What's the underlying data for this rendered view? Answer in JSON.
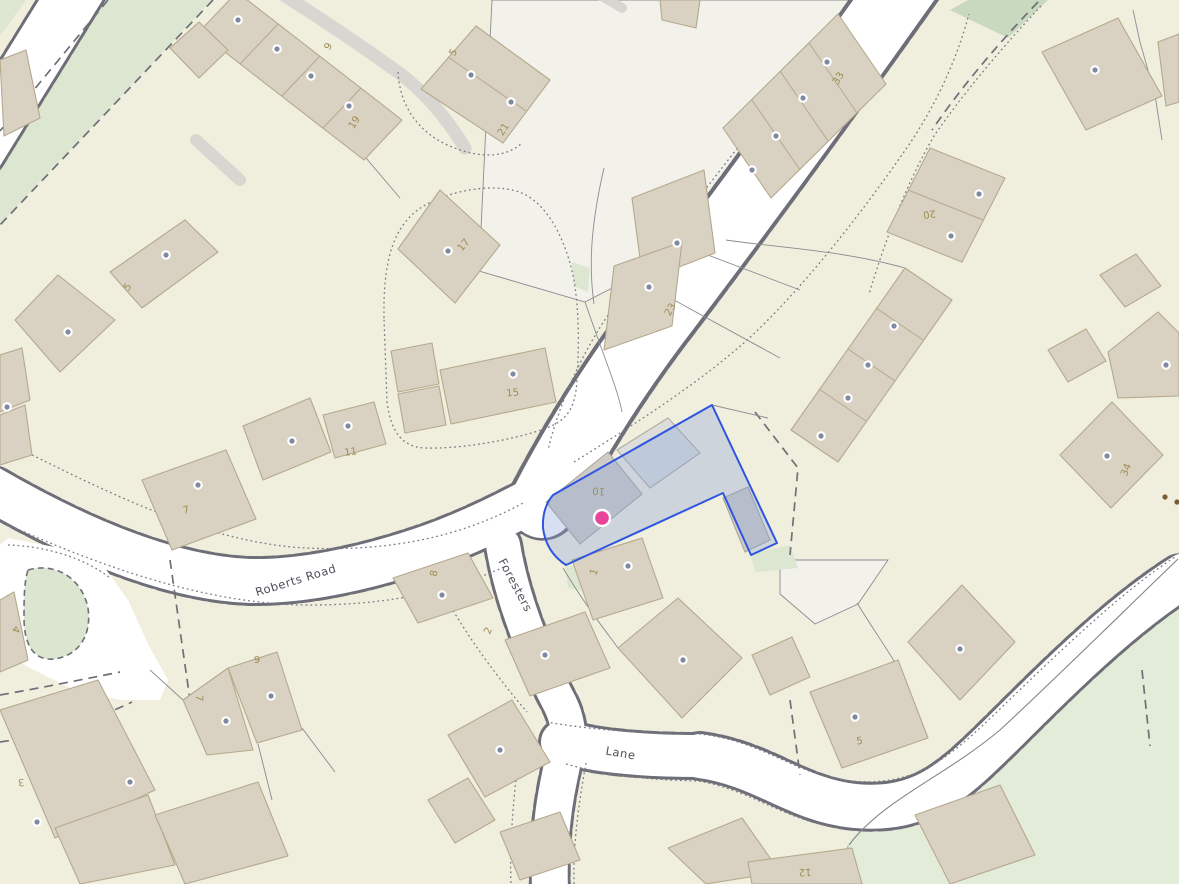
{
  "map": {
    "road_labels": [
      {
        "text": "Roberts Road",
        "x": 297,
        "y": 584,
        "rot": -17
      },
      {
        "text": "Foresters",
        "x": 512,
        "y": 587,
        "rot": 62
      },
      {
        "text": "Lane",
        "x": 620,
        "y": 757,
        "rot": 10
      }
    ],
    "house_numbers": [
      {
        "text": "9",
        "x": 331,
        "y": 48,
        "rot": -58
      },
      {
        "text": "19",
        "x": 357,
        "y": 124,
        "rot": -58
      },
      {
        "text": "5",
        "x": 456,
        "y": 54,
        "rot": -58
      },
      {
        "text": "21",
        "x": 506,
        "y": 131,
        "rot": -58
      },
      {
        "text": "33",
        "x": 841,
        "y": 80,
        "rot": -58
      },
      {
        "text": "17",
        "x": 466,
        "y": 247,
        "rot": -50
      },
      {
        "text": "23",
        "x": 673,
        "y": 311,
        "rot": -60
      },
      {
        "text": "15",
        "x": 513,
        "y": 396,
        "rot": -6
      },
      {
        "text": "11",
        "x": 351,
        "y": 455,
        "rot": -8
      },
      {
        "text": "5",
        "x": 130,
        "y": 289,
        "rot": -50
      },
      {
        "text": "7",
        "x": 187,
        "y": 513,
        "rot": -15
      },
      {
        "text": "20",
        "x": 929,
        "y": 211,
        "rot": 172
      },
      {
        "text": "34",
        "x": 1129,
        "y": 471,
        "rot": -68
      },
      {
        "text": "8",
        "x": 437,
        "y": 574,
        "rot": -78
      },
      {
        "text": "2",
        "x": 491,
        "y": 632,
        "rot": -65
      },
      {
        "text": "1",
        "x": 597,
        "y": 573,
        "rot": -70
      },
      {
        "text": "5",
        "x": 860,
        "y": 744,
        "rot": -8
      },
      {
        "text": "9",
        "x": 257,
        "y": 663,
        "rot": 0
      },
      {
        "text": "7",
        "x": 196,
        "y": 698,
        "rot": 92
      },
      {
        "text": "3",
        "x": 21,
        "y": 779,
        "rot": 175
      },
      {
        "text": "4",
        "x": 13,
        "y": 628,
        "rot": 115
      },
      {
        "text": "12",
        "x": 805,
        "y": 869,
        "rot": 178
      },
      {
        "text": "10",
        "x": 599,
        "y": 488,
        "rot": 186
      }
    ],
    "marker": {
      "x": 602,
      "y": 518,
      "radius": 8,
      "color": "#e8449a",
      "ring": "#ffffff"
    },
    "selection": {
      "stroke": "#2f55e0",
      "fill": "rgba(130,160,215,0.32)"
    },
    "entrance_markers": [
      [
        238,
        20
      ],
      [
        277,
        49
      ],
      [
        311,
        76
      ],
      [
        349,
        106
      ],
      [
        471,
        75
      ],
      [
        511,
        102
      ],
      [
        827,
        62
      ],
      [
        803,
        98
      ],
      [
        776,
        136
      ],
      [
        752,
        170
      ],
      [
        1095,
        70
      ],
      [
        979,
        194
      ],
      [
        951,
        236
      ],
      [
        677,
        243
      ],
      [
        649,
        287
      ],
      [
        448,
        251
      ],
      [
        513,
        374
      ],
      [
        166,
        255
      ],
      [
        68,
        332
      ],
      [
        7,
        407
      ],
      [
        292,
        441
      ],
      [
        348,
        426
      ],
      [
        198,
        485
      ],
      [
        442,
        595
      ],
      [
        545,
        655
      ],
      [
        628,
        566
      ],
      [
        683,
        660
      ],
      [
        500,
        750
      ],
      [
        271,
        696
      ],
      [
        226,
        721
      ],
      [
        130,
        782
      ],
      [
        37,
        822
      ],
      [
        855,
        717
      ],
      [
        960,
        649
      ],
      [
        894,
        326
      ],
      [
        868,
        365
      ],
      [
        848,
        398
      ],
      [
        821,
        436
      ],
      [
        1166,
        365
      ],
      [
        1107,
        456
      ]
    ],
    "trees": [
      [
        1165,
        497
      ],
      [
        1177,
        502
      ]
    ],
    "colors": {
      "land": "#f0eedd",
      "pale_parcel": "#f2f2ea",
      "green_area": "#e3ecd9",
      "green_strip": "#dce6d0",
      "green_dark": "#c9d9c0",
      "road": "#ffffff",
      "road_casing": "#6e6e78",
      "building": "#d9d1c2",
      "building_stroke": "#b5a98d",
      "building_gray": "#cfccc6",
      "parcel_line": "#8b8b94",
      "house_number": "#9f8e55",
      "road_label": "#4e4e59",
      "entrance_dot": "#7f8aa0",
      "tree_dot": "#7a5c33"
    }
  }
}
